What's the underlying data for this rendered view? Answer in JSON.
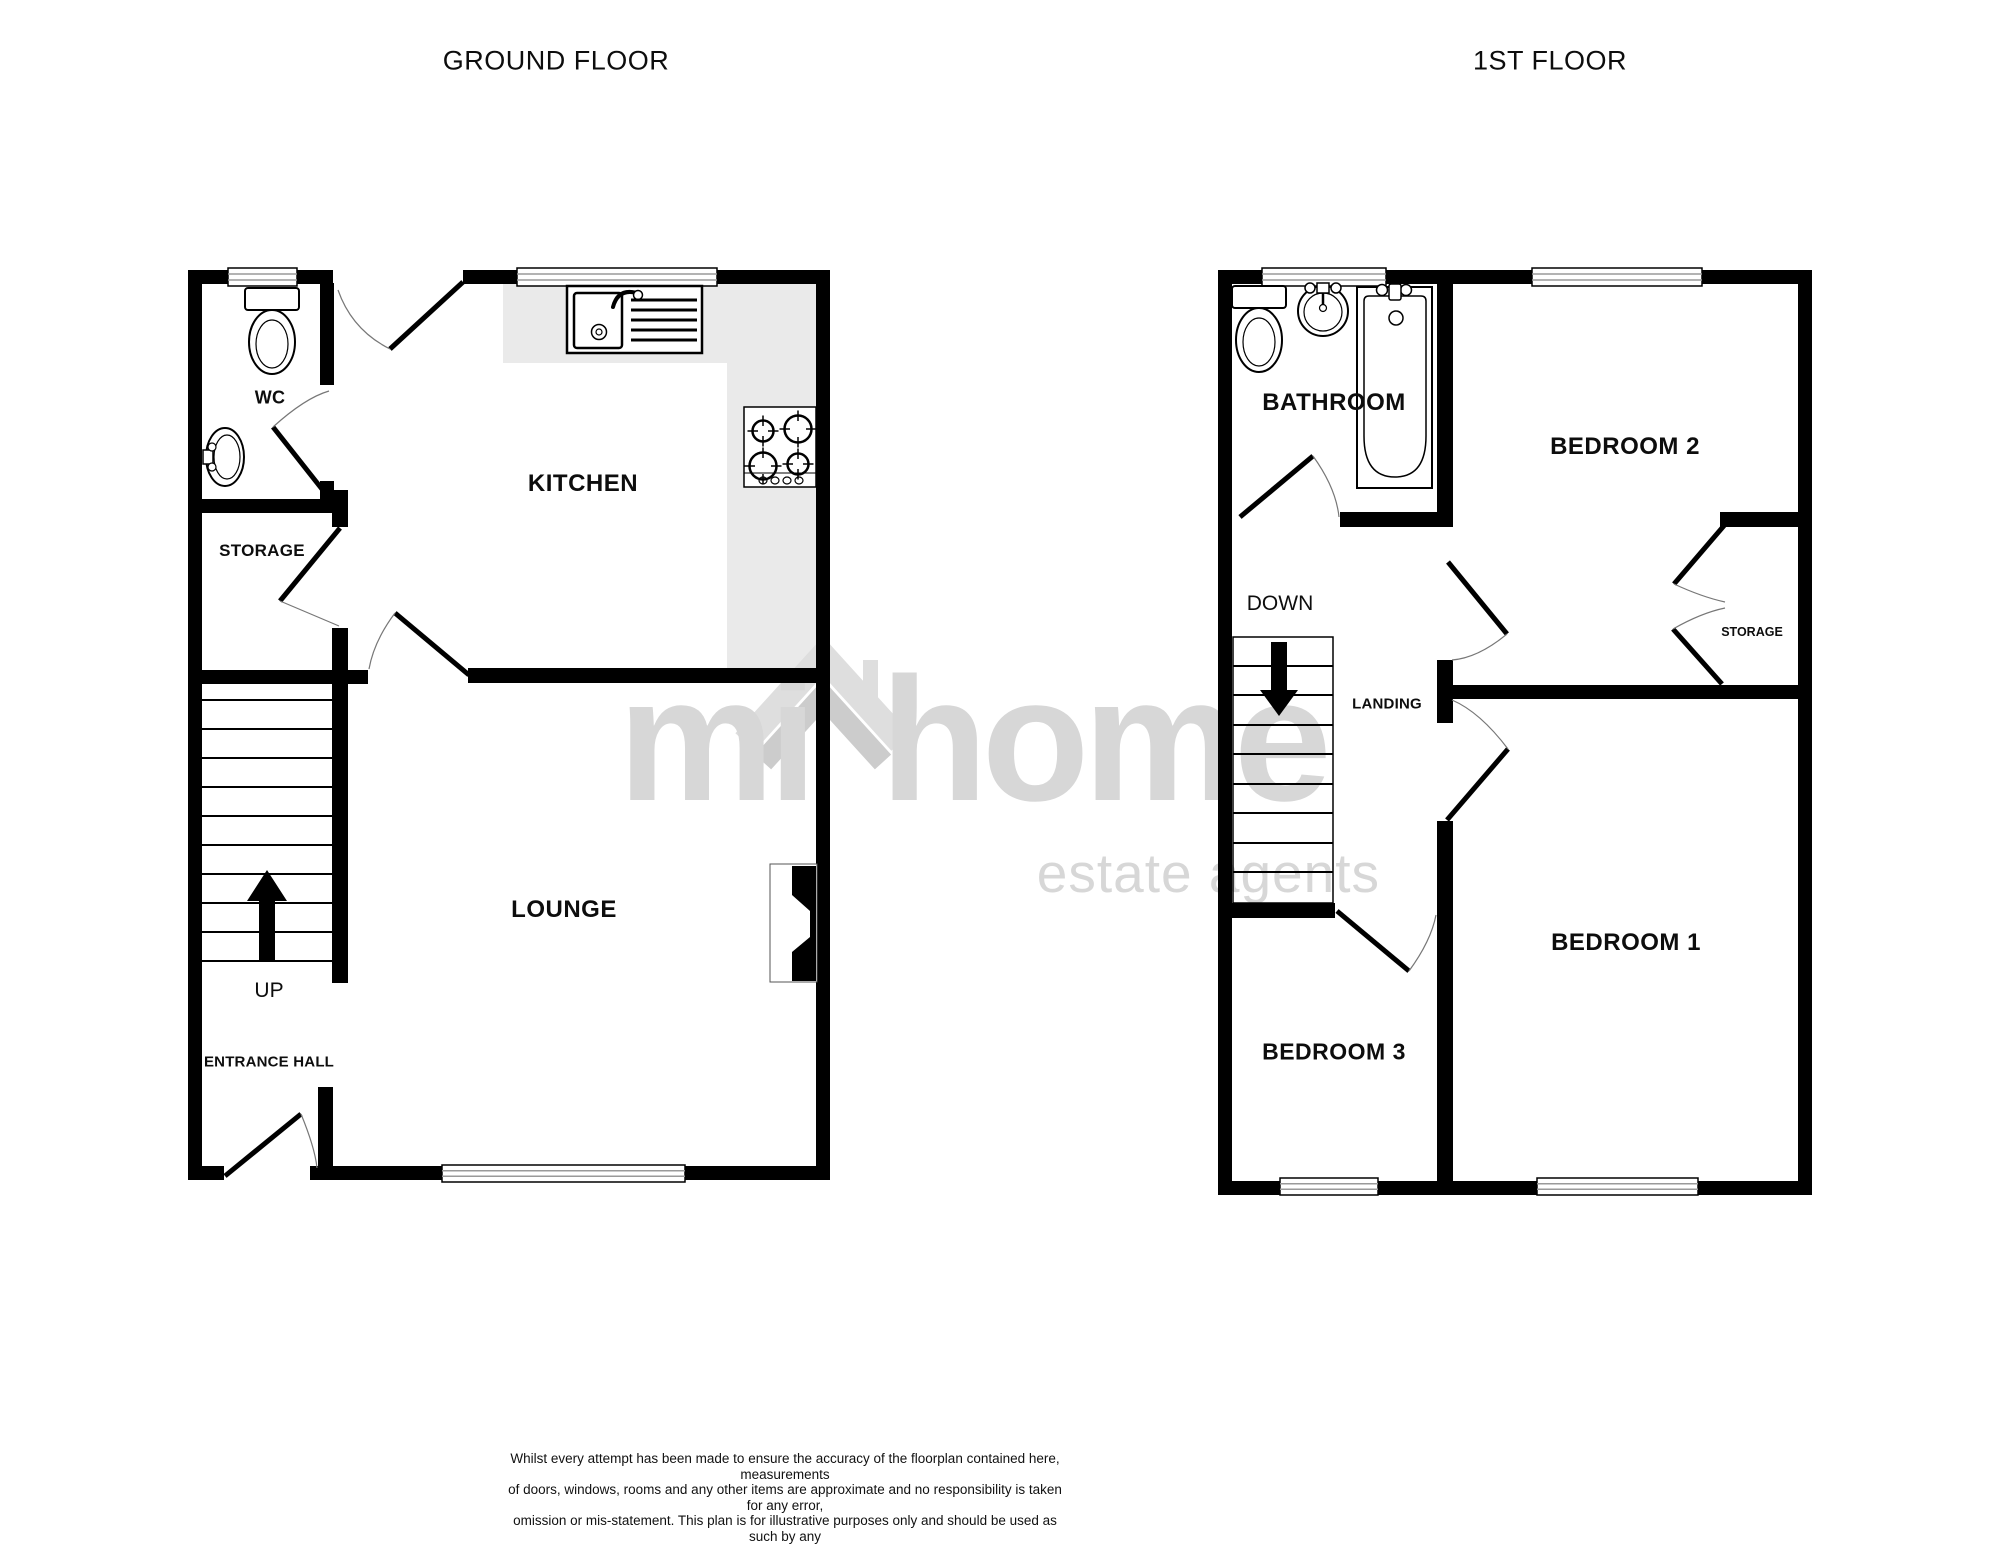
{
  "header": {
    "ground_title": "GROUND FLOOR",
    "first_title": "1ST FLOOR"
  },
  "ground_floor": {
    "wc": "WC",
    "kitchen": "KITCHEN",
    "storage": "STORAGE",
    "up": "UP",
    "entrance_hall": "ENTRANCE HALL",
    "lounge": "LOUNGE"
  },
  "first_floor": {
    "bathroom": "BATHROOM",
    "bedroom2": "BEDROOM 2",
    "down": "DOWN",
    "landing": "LANDING",
    "storage": "STORAGE",
    "bedroom1": "BEDROOM 1",
    "bedroom3": "BEDROOM 3"
  },
  "watermark": {
    "brand": "mi home",
    "tagline": "estate agents"
  },
  "footer": {
    "disclaimer_lines": [
      "Whilst every attempt has been made to ensure the accuracy of the floorplan contained here, measurements",
      "of doors, windows, rooms and any other items are approximate and no responsibility is taken for any error,",
      "omission or mis-statement. This plan is for illustrative purposes only and should be used as such by any",
      "prospective purchaser. The services, systems and appliances shown have not been tested and no guarantee",
      "as to their operability or efficiency can be given."
    ],
    "credit": "Made with Metropix ©2025"
  },
  "colors": {
    "wall": "#000000",
    "counter": "#eaeaea",
    "watermark": "#d7d7d7",
    "window_line": "#9a9a9a"
  }
}
